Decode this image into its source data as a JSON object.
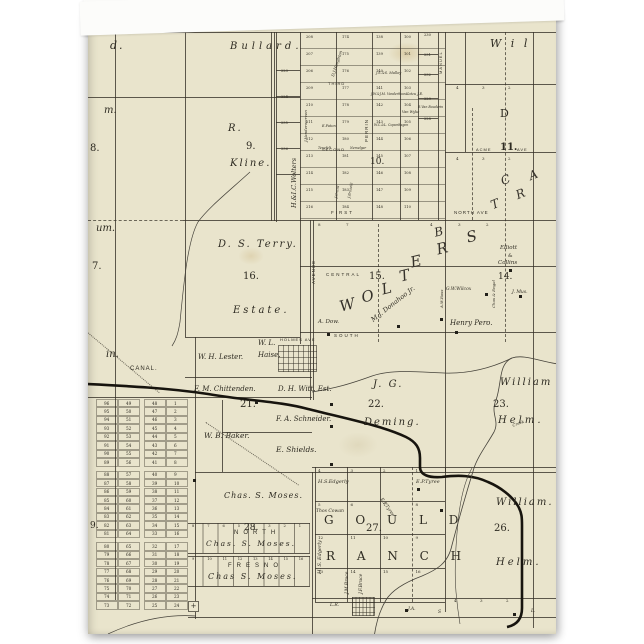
{
  "card": {
    "kind": "greeting-card-front-vintage-plat-map",
    "colors": {
      "paper": "#e9e4cc",
      "ink": "#2e2b22",
      "line": "rgba(52,48,38,0.78)",
      "canal": "#17140e",
      "card_back": "#fbfbf9"
    }
  },
  "labels": [
    {
      "n": "cut-label-d",
      "t": "d.",
      "x": 22,
      "y": 28,
      "fs": 11,
      "it": 1,
      "ls": 2
    },
    {
      "n": "bullard-label",
      "t": "Bullard.",
      "x": 142,
      "y": 30,
      "fs": 10,
      "it": 1,
      "ls": 4
    },
    {
      "n": "williams-cut-label",
      "t": "W i l",
      "x": 402,
      "y": 26,
      "fs": 11,
      "it": 1,
      "ls": 3
    },
    {
      "n": "cut-label-m",
      "t": "m.",
      "x": 16,
      "y": 94,
      "fs": 10,
      "it": 1
    },
    {
      "n": "section-8",
      "t": "8.",
      "x": 2,
      "y": 132,
      "fs": 10
    },
    {
      "n": "kline-initial",
      "t": "R.",
      "x": 140,
      "y": 112,
      "fs": 10,
      "it": 1,
      "ls": 2
    },
    {
      "n": "section-9",
      "t": "9.",
      "x": 158,
      "y": 130,
      "fs": 10
    },
    {
      "n": "kline-name",
      "t": "Kline.",
      "x": 142,
      "y": 147,
      "fs": 10,
      "it": 1,
      "ls": 2
    },
    {
      "n": "cut-label-um",
      "t": "um.",
      "x": 8,
      "y": 212,
      "fs": 10,
      "it": 1
    },
    {
      "n": "section-17-cut",
      "t": "7.",
      "x": 4,
      "y": 250,
      "fs": 10
    },
    {
      "n": "terry-name",
      "t": "D. S. Terry.",
      "x": 130,
      "y": 228,
      "fs": 10,
      "it": 1,
      "ls": 2
    },
    {
      "n": "section-16",
      "t": "16.",
      "x": 155,
      "y": 260,
      "fs": 10
    },
    {
      "n": "terry-estate",
      "t": "Estate.",
      "x": 145,
      "y": 294,
      "fs": 10,
      "it": 1,
      "ls": 3
    },
    {
      "n": "cut-label-in",
      "t": "in.",
      "x": 18,
      "y": 338,
      "fs": 10,
      "it": 1
    },
    {
      "n": "canal-label",
      "t": "CANAL.",
      "x": 42,
      "y": 354,
      "fs": 6,
      "ls": 1,
      "st": 1
    },
    {
      "n": "lester-name",
      "t": "W. H. Lester.",
      "x": 110,
      "y": 342,
      "fs": 7,
      "it": 1
    },
    {
      "n": "haise-initials",
      "t": "W. L.",
      "x": 170,
      "y": 328,
      "fs": 7,
      "it": 1
    },
    {
      "n": "haise-name",
      "t": "Haise.",
      "x": 170,
      "y": 340,
      "fs": 7,
      "it": 1
    },
    {
      "n": "chittenden-name",
      "t": "F. M. Chittenden.",
      "x": 106,
      "y": 374,
      "fs": 7,
      "it": 1
    },
    {
      "n": "witt-name",
      "t": "D. H. Witt. Est.",
      "x": 190,
      "y": 374,
      "fs": 7,
      "it": 1
    },
    {
      "n": "section-21",
      "t": "21.",
      "x": 152,
      "y": 388,
      "fs": 10
    },
    {
      "n": "schneider-name",
      "t": "F. A. Schneider.",
      "x": 188,
      "y": 404,
      "fs": 7,
      "it": 1
    },
    {
      "n": "baker-name",
      "t": "W. B. Baker.",
      "x": 116,
      "y": 420,
      "fs": 7.5,
      "it": 1
    },
    {
      "n": "shields-name",
      "t": "E. Shields.",
      "x": 188,
      "y": 434,
      "fs": 7.5,
      "it": 1
    },
    {
      "n": "moses-name-upper",
      "t": "Chas. S. Moses.",
      "x": 136,
      "y": 480,
      "fs": 8,
      "it": 1,
      "ls": 1
    },
    {
      "n": "section-28",
      "t": "28.",
      "x": 156,
      "y": 512,
      "fs": 9
    },
    {
      "n": "north-fresno-north",
      "t": "NORTH",
      "x": 146,
      "y": 518,
      "fs": 6,
      "ls": 5,
      "st": 1
    },
    {
      "n": "moses-name-north-strip",
      "t": "Chas. S. Moses.",
      "x": 118,
      "y": 528,
      "fs": 7.5,
      "it": 1,
      "ls": 2
    },
    {
      "n": "north-fresno-fresno",
      "t": "FRESNO",
      "x": 140,
      "y": 551,
      "fs": 6,
      "ls": 5,
      "st": 1
    },
    {
      "n": "moses-name-fresno-strip",
      "t": "Chas S. Moses.",
      "x": 120,
      "y": 561,
      "fs": 8,
      "it": 1,
      "ls": 2
    },
    {
      "n": "deming-initials",
      "t": "J. G.",
      "x": 285,
      "y": 368,
      "fs": 10,
      "it": 1,
      "ls": 2
    },
    {
      "n": "section-22",
      "t": "22.",
      "x": 280,
      "y": 388,
      "fs": 10
    },
    {
      "n": "deming-name",
      "t": "Deming.",
      "x": 276,
      "y": 406,
      "fs": 10,
      "it": 1,
      "ls": 2
    },
    {
      "n": "helm23-william",
      "t": "William",
      "x": 412,
      "y": 366,
      "fs": 10,
      "it": 1,
      "ls": 2
    },
    {
      "n": "section-23",
      "t": "23.",
      "x": 405,
      "y": 388,
      "fs": 10
    },
    {
      "n": "helm23-name",
      "t": "Helm.",
      "x": 410,
      "y": 404,
      "fs": 10,
      "it": 1,
      "ls": 3
    },
    {
      "n": "creek-label",
      "t": "Creek",
      "x": 424,
      "y": 412,
      "fs": 4,
      "it": 1,
      "rot": -20
    },
    {
      "n": "edgerly-name",
      "t": "H.S.Edgerly",
      "x": 230,
      "y": 468,
      "fs": 5,
      "it": 1
    },
    {
      "n": "tyree-name",
      "t": "E.P.Tyree",
      "x": 328,
      "y": 468,
      "fs": 5,
      "it": 1
    },
    {
      "n": "cowan-name",
      "t": "Thos Cowan",
      "x": 228,
      "y": 498,
      "fs": 4.5,
      "it": 1
    },
    {
      "n": "section-27",
      "t": "27.",
      "x": 278,
      "y": 512,
      "fs": 10
    },
    {
      "n": "gould-word",
      "t": "G O U L D",
      "x": 236,
      "y": 502,
      "fs": 12,
      "ls": 9
    },
    {
      "n": "ranch-word",
      "t": "R A N C H",
      "x": 238,
      "y": 538,
      "fs": 12,
      "ls": 9
    },
    {
      "n": "edgerly-vertical",
      "t": "H. S. Edgerly",
      "x": 230,
      "y": 562,
      "fs": 5,
      "it": 1,
      "rot": -90
    },
    {
      "n": "jm-bruce-vertical",
      "t": "J.M.Bruce",
      "x": 258,
      "y": 582,
      "fs": 4.5,
      "it": 1,
      "rot": -90
    },
    {
      "n": "jf-bruce-vertical",
      "t": "J.F.Bruce",
      "x": 272,
      "y": 582,
      "fs": 4.5,
      "it": 1,
      "rot": -90
    },
    {
      "n": "helm26-william",
      "t": "William.",
      "x": 408,
      "y": 486,
      "fs": 10,
      "it": 1,
      "ls": 2
    },
    {
      "n": "section-26",
      "t": "26.",
      "x": 406,
      "y": 512,
      "fs": 10
    },
    {
      "n": "helm26-name",
      "t": "Helm.",
      "x": 408,
      "y": 546,
      "fs": 10,
      "it": 1,
      "ls": 3
    },
    {
      "n": "henry-pero-name",
      "t": "Henry Pero.",
      "x": 362,
      "y": 308,
      "fs": 7,
      "it": 1
    },
    {
      "n": "wilcox-name",
      "t": "G.W.Wilcox",
      "x": 358,
      "y": 276,
      "fs": 4.5,
      "it": 1
    },
    {
      "n": "ross-vertical",
      "t": "A.W.Ross",
      "x": 352,
      "y": 296,
      "fs": 4,
      "it": 1,
      "rot": -90
    },
    {
      "n": "elliott-name",
      "t": "Elliott",
      "x": 412,
      "y": 234,
      "fs": 5.5,
      "it": 1
    },
    {
      "n": "elliott-amp",
      "t": "&",
      "x": 420,
      "y": 242,
      "fs": 5
    },
    {
      "n": "collins-name",
      "t": "Collins",
      "x": 410,
      "y": 249,
      "fs": 5.5,
      "it": 1
    },
    {
      "n": "section-14",
      "t": "14.",
      "x": 410,
      "y": 261,
      "fs": 9
    },
    {
      "n": "mus-name",
      "t": "J. Mus.",
      "x": 424,
      "y": 279,
      "fs": 4.5,
      "it": 1
    },
    {
      "n": "engel-vertical",
      "t": "Chas & Engel",
      "x": 404,
      "y": 296,
      "fs": 4,
      "it": 1,
      "rot": -90
    },
    {
      "n": "dow-name",
      "t": "A. Dow.",
      "x": 230,
      "y": 308,
      "fs": 5.5,
      "it": 1
    },
    {
      "n": "donahoo-name",
      "t": "M.J. Donahoo Jr.",
      "x": 282,
      "y": 306,
      "fs": 6.5,
      "it": 1,
      "rot": -38
    },
    {
      "n": "section-15",
      "t": "15.",
      "x": 281,
      "y": 260,
      "fs": 10
    },
    {
      "n": "central-ave",
      "t": "CENTRAL",
      "x": 238,
      "y": 261,
      "fs": 4.5,
      "ls": 2,
      "st": 1
    },
    {
      "n": "south-ave",
      "t": "SOUTH",
      "x": 246,
      "y": 322,
      "fs": 4.5,
      "ls": 2,
      "st": 1
    },
    {
      "n": "holmes-ave",
      "t": "HOLMES AVE",
      "x": 192,
      "y": 326,
      "fs": 4,
      "ls": 1,
      "st": 1
    },
    {
      "n": "first-ave",
      "t": "FIRST",
      "x": 243,
      "y": 199,
      "fs": 4.5,
      "ls": 2,
      "st": 1
    },
    {
      "n": "second-ave",
      "t": "SECOND",
      "x": 234,
      "y": 136,
      "fs": 4,
      "ls": 1,
      "st": 1
    },
    {
      "n": "third-ave",
      "t": "THIRD",
      "x": 240,
      "y": 70,
      "fs": 4,
      "ls": 1,
      "st": 1
    },
    {
      "n": "north-ave",
      "t": "NORTH AVE",
      "x": 366,
      "y": 199,
      "fs": 4.5,
      "ls": 1,
      "st": 1
    },
    {
      "n": "acme-ave",
      "t": "ACME",
      "x": 388,
      "y": 136,
      "fs": 4,
      "ls": 1,
      "st": 1
    },
    {
      "n": "section-11",
      "t": "11.",
      "x": 412,
      "y": 131,
      "fs": 10,
      "b": 1
    },
    {
      "n": "ave-label",
      "t": "AVE",
      "x": 429,
      "y": 136,
      "fs": 4,
      "ls": 1,
      "st": 1
    },
    {
      "n": "section-10",
      "t": "10.",
      "x": 282,
      "y": 146,
      "fs": 9
    },
    {
      "n": "avenue-vertical",
      "t": "AVENUE",
      "x": 224,
      "y": 272,
      "fs": 4.5,
      "ls": 1,
      "st": 1,
      "rot": -90
    },
    {
      "n": "perrin-vertical",
      "t": "PERRIN",
      "x": 277,
      "y": 130,
      "fs": 4.5,
      "ls": 1,
      "st": 1,
      "rot": -90
    },
    {
      "n": "manuel-vertical",
      "t": "MANUEL",
      "x": 351,
      "y": 62,
      "fs": 4,
      "ls": 1,
      "st": 1,
      "rot": -90
    },
    {
      "n": "wolters-strip-vertical",
      "t": "H.&I.C.Wolters",
      "x": 203,
      "y": 196,
      "fs": 6.5,
      "it": 1,
      "rot": -90
    },
    {
      "n": "vanderwerven-vertical",
      "t": "J.Vanderwerven",
      "x": 216,
      "y": 130,
      "fs": 4,
      "it": 1,
      "rot": -90
    },
    {
      "n": "houghton-vertical",
      "t": "D.J.Houghton",
      "x": 243,
      "y": 64,
      "fs": 4,
      "it": 1,
      "rot": -72
    },
    {
      "n": "malloy-name",
      "t": "J.S.&S. Malloy",
      "x": 288,
      "y": 60,
      "fs": 3.5,
      "it": 1
    },
    {
      "n": "vanderhoos-name",
      "t": "J.W.&J.M. Vanderhoos",
      "x": 283,
      "y": 81,
      "fs": 3.2,
      "it": 1
    },
    {
      "n": "kotzu-name",
      "t": "Kotzu J.E.",
      "x": 318,
      "y": 81,
      "fs": 3.5,
      "it": 1
    },
    {
      "n": "vanwyke-name",
      "t": "Van Wyke",
      "x": 314,
      "y": 99,
      "fs": 3.5,
      "it": 1
    },
    {
      "n": "bouderin-name",
      "t": "R.Van Bouderin",
      "x": 330,
      "y": 94,
      "fs": 3.2,
      "it": 1
    },
    {
      "n": "faton-name",
      "t": "E.Faton",
      "x": 234,
      "y": 113,
      "fs": 3.5,
      "it": 1
    },
    {
      "n": "copenhagen-name",
      "t": "W.C.&L. Copenhagen",
      "x": 286,
      "y": 112,
      "fs": 3.2,
      "it": 1
    },
    {
      "n": "tenefelt-name",
      "t": "Tenefelt",
      "x": 230,
      "y": 135,
      "fs": 3.2,
      "it": 1
    },
    {
      "n": "nemelgar-name",
      "t": "Nemelgar",
      "x": 262,
      "y": 135,
      "fs": 3.2,
      "it": 1
    },
    {
      "n": "crans-vertical",
      "t": "J.Crans",
      "x": 247,
      "y": 186,
      "fs": 3.5,
      "it": 1,
      "rot": -80
    },
    {
      "n": "braselli-vertical",
      "t": "J.Braselli",
      "x": 260,
      "y": 186,
      "fs": 3.5,
      "it": 1,
      "rot": -80
    },
    {
      "n": "lr-name",
      "t": "L.R.",
      "x": 242,
      "y": 592,
      "fs": 4.5,
      "it": 1
    },
    {
      "n": "ja-name",
      "t": "J.A.",
      "x": 320,
      "y": 596,
      "fs": 4.5,
      "it": 1
    },
    {
      "n": "s-label",
      "t": "S",
      "x": 350,
      "y": 599,
      "fs": 4.5,
      "it": 1
    },
    {
      "n": "l-label",
      "t": "L.",
      "x": 443,
      "y": 598,
      "fs": 4.5,
      "it": 1
    },
    {
      "n": "section-d",
      "t": "D",
      "x": 412,
      "y": 96,
      "fs": 11
    },
    {
      "n": "section-29-cut",
      "t": "9.",
      "x": 2,
      "y": 510,
      "fs": 9
    },
    {
      "n": "tyree-diagonal",
      "t": "E.P.Tyree",
      "x": 294,
      "y": 486,
      "fs": 4.5,
      "it": 1,
      "rot": 55
    }
  ],
  "big_letters": [
    {
      "n": "wolters-letter-w",
      "t": "W",
      "x": 250,
      "y": 288,
      "fs": 15,
      "rot": -14
    },
    {
      "n": "wolters-letter-o",
      "t": "O",
      "x": 272,
      "y": 279,
      "fs": 15,
      "rot": -14
    },
    {
      "n": "wolters-letter-l",
      "t": "L",
      "x": 292,
      "y": 271,
      "fs": 15,
      "rot": -14
    },
    {
      "n": "wolters-letter-t",
      "t": "T",
      "x": 310,
      "y": 258,
      "fs": 15,
      "rot": -14
    },
    {
      "n": "wolters-letter-e",
      "t": "E",
      "x": 321,
      "y": 244,
      "fs": 15,
      "rot": -14
    },
    {
      "n": "wolters-letter-r",
      "t": "R",
      "x": 347,
      "y": 231,
      "fs": 15,
      "rot": -14
    },
    {
      "n": "wolters-letter-s",
      "t": "S",
      "x": 377,
      "y": 219,
      "fs": 15,
      "rot": -14
    },
    {
      "n": "tract-letter-b",
      "t": "B",
      "x": 345,
      "y": 215,
      "fs": 12,
      "rot": -14
    },
    {
      "n": "tract-letter-t",
      "t": "T",
      "x": 401,
      "y": 188,
      "fs": 12,
      "rot": -22
    },
    {
      "n": "tract-letter-r",
      "t": "R",
      "x": 426,
      "y": 178,
      "fs": 12,
      "rot": -22
    },
    {
      "n": "tract-letter-c",
      "t": "C",
      "x": 411,
      "y": 164,
      "fs": 12,
      "rot": -22
    },
    {
      "n": "tract-letter-a",
      "t": "A",
      "x": 439,
      "y": 159,
      "fs": 12,
      "rot": -22
    }
  ],
  "plat_top": {
    "cols": [
      {
        "x": 218,
        "nums": [
          208,
          207,
          206,
          209,
          210,
          211,
          212,
          213,
          214,
          215,
          216
        ]
      },
      {
        "x": 254,
        "nums": [
          174,
          175,
          176,
          177,
          178,
          179,
          180,
          181,
          182,
          183,
          184
        ]
      },
      {
        "x": 288,
        "nums": [
          138,
          139,
          140,
          141,
          142,
          143,
          144,
          145,
          146,
          147,
          148
        ]
      },
      {
        "x": 316,
        "nums": [
          100,
          101,
          102,
          103,
          104,
          105,
          106,
          107,
          108,
          109,
          110
        ]
      }
    ],
    "y0": 24,
    "row_h": 17
  },
  "plat_right_col": {
    "x": 336,
    "nums": [
      230,
      231,
      232,
      229,
      228
    ],
    "ys": [
      22,
      42,
      62,
      86,
      106
    ]
  },
  "wolters_strip": {
    "x": 193,
    "nums": [
      223,
      224,
      235,
      236
    ],
    "ys": [
      58,
      84,
      110,
      136
    ]
  },
  "lot_grid": {
    "rows": [
      [
        96,
        49,
        48,
        1
      ],
      [
        95,
        50,
        47,
        2
      ],
      [
        94,
        51,
        46,
        3
      ],
      [
        93,
        52,
        45,
        4
      ],
      [
        92,
        53,
        44,
        5
      ],
      [
        91,
        54,
        43,
        6
      ],
      [
        90,
        55,
        42,
        7
      ],
      [
        89,
        56,
        41,
        8
      ],
      [
        88,
        57,
        40,
        9
      ],
      [
        87,
        58,
        39,
        10
      ],
      [
        86,
        59,
        38,
        11
      ],
      [
        85,
        60,
        37,
        12
      ],
      [
        84,
        61,
        36,
        13
      ],
      [
        83,
        62,
        35,
        14
      ],
      [
        82,
        63,
        34,
        15
      ],
      [
        81,
        64,
        33,
        16
      ],
      [
        80,
        65,
        32,
        17
      ],
      [
        79,
        66,
        31,
        18
      ],
      [
        78,
        67,
        30,
        19
      ],
      [
        77,
        68,
        29,
        20
      ],
      [
        76,
        69,
        28,
        21
      ],
      [
        75,
        70,
        27,
        22
      ],
      [
        74,
        71,
        26,
        23
      ],
      [
        73,
        72,
        25,
        24
      ]
    ]
  },
  "gould": {
    "rows": [
      [
        "4",
        "3",
        "2",
        "1"
      ],
      [
        "5",
        "6",
        "7",
        "8"
      ],
      [
        "12",
        "11",
        "10",
        "9"
      ],
      [
        "13",
        "14",
        "15",
        "16"
      ]
    ]
  },
  "fresno_strips": {
    "strips": [
      {
        "y": 511,
        "nums": [
          "8",
          "7",
          "6",
          "5",
          "4",
          "3",
          "2",
          "1"
        ]
      },
      {
        "y": 544,
        "nums": [
          "9",
          "10",
          "11",
          "12",
          "13",
          "14",
          "15",
          "16"
        ]
      }
    ]
  },
  "ticks": [
    {
      "x": 368,
      "y": 74,
      "t": "4"
    },
    {
      "x": 394,
      "y": 74,
      "t": "3"
    },
    {
      "x": 420,
      "y": 74,
      "t": "2"
    },
    {
      "x": 368,
      "y": 145,
      "t": "4"
    },
    {
      "x": 394,
      "y": 145,
      "t": "3"
    },
    {
      "x": 420,
      "y": 145,
      "t": "2"
    },
    {
      "x": 342,
      "y": 211,
      "t": "4"
    },
    {
      "x": 370,
      "y": 211,
      "t": "3"
    },
    {
      "x": 398,
      "y": 211,
      "t": "2"
    },
    {
      "x": 366,
      "y": 587,
      "t": "4"
    },
    {
      "x": 392,
      "y": 587,
      "t": "3"
    },
    {
      "x": 418,
      "y": 587,
      "t": "2"
    },
    {
      "x": 230,
      "y": 211,
      "t": "8"
    },
    {
      "x": 258,
      "y": 211,
      "t": "7"
    }
  ],
  "plus_mark": {
    "t": "+"
  }
}
